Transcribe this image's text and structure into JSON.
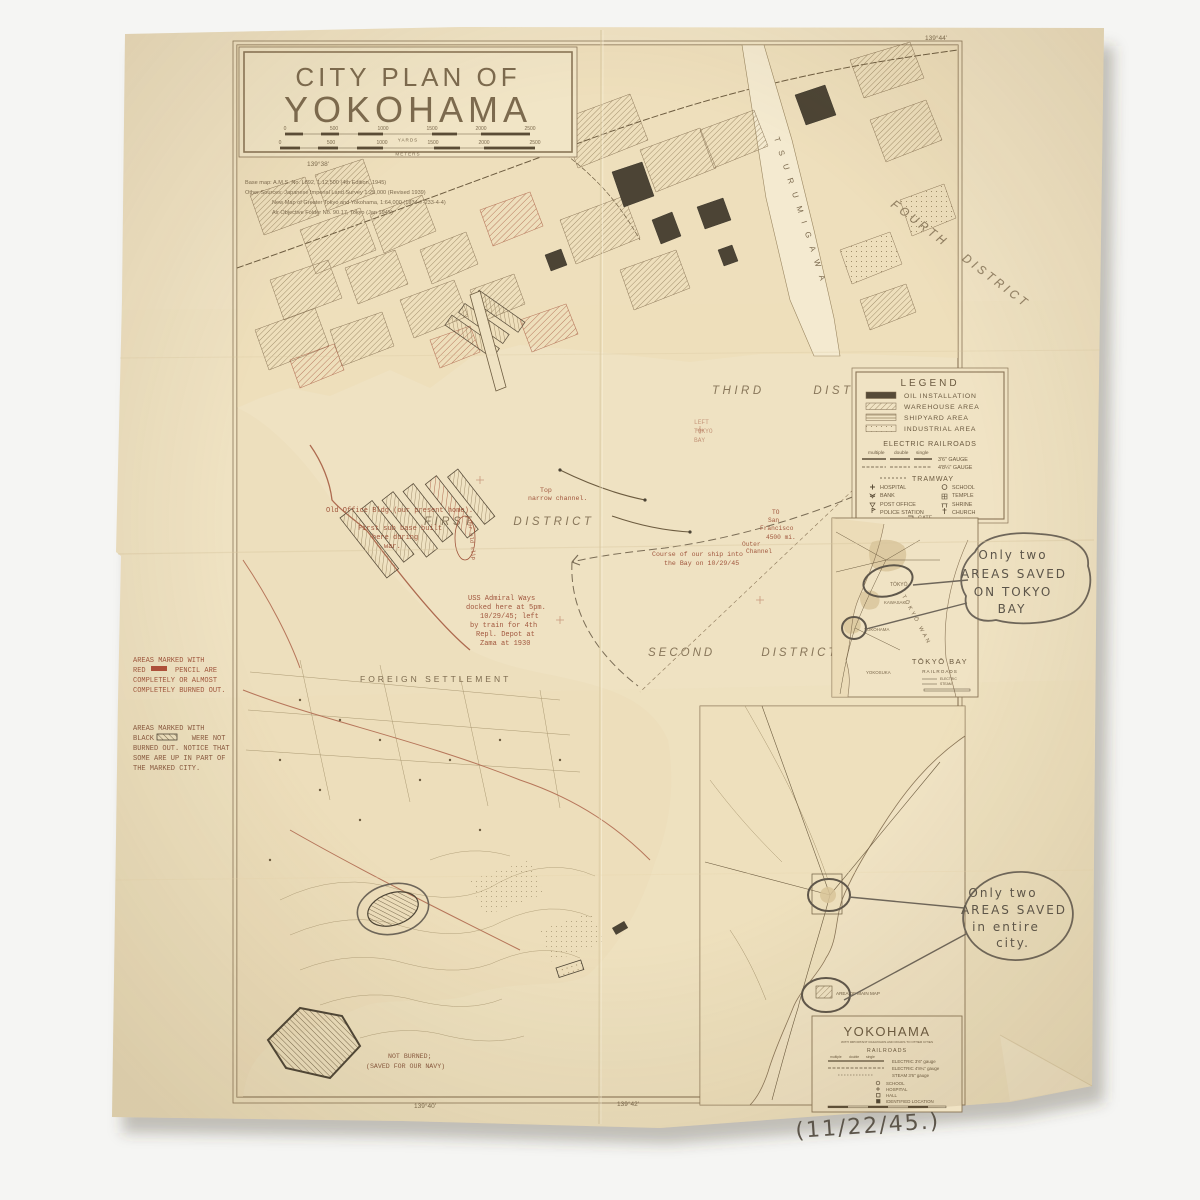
{
  "title_box": {
    "kicker": "CITY PLAN OF",
    "title": "YOKOHAMA",
    "yards_label": "YARDS",
    "meters_label": "METERS",
    "yard_ticks": [
      "0",
      "500",
      "1000",
      "1500",
      "2000",
      "2500"
    ],
    "meter_ticks": [
      "0",
      "500",
      "1000",
      "1500",
      "2000",
      "2500"
    ]
  },
  "source_notes": {
    "line1": "Base map: A.M.S. No. L892, 1:12,500 (4th Edition, 1945)",
    "line2": "Other Sources: Japanese Imperial Land Survey 1:25,000 (Revised 1939)",
    "line3": "New Map of Greater Tokyo and Yokohama, 1:64,000 (1934-7-233-4-4)",
    "line4": "Air Objective Folder No. 90.17, Tokyo (Jan 1945)"
  },
  "coords": {
    "top": "139°38'",
    "top_right": "139°44'",
    "bottom_left": "139°40'",
    "bottom_right": "139°42'"
  },
  "districts": {
    "first": "FIRST DISTRICT",
    "second": "SECOND DISTRICT",
    "third": "THIRD DISTRICT",
    "fourth": "FOURTH DISTRICT"
  },
  "map_labels": {
    "tsurumi": "TSURUMIGAWA",
    "foreign_settlement": "FOREIGN SETTLEMENT"
  },
  "legend": {
    "title": "LEGEND",
    "area_items": [
      "OIL INSTALLATION",
      "WAREHOUSE AREA",
      "SHIPYARD AREA",
      "INDUSTRIAL AREA"
    ],
    "electric_railroads": "ELECTRIC RAILROADS",
    "rail_words": [
      "multiple",
      "double",
      "single"
    ],
    "gauge1": "3'6\" GAUGE",
    "gauge2": "4'8¼\" GAUGE",
    "tramway": "TRAMWAY",
    "symbols_left": [
      "HOSPITAL",
      "BANK",
      "POST OFFICE",
      "POLICE STATION"
    ],
    "symbols_right": [
      "SCHOOL",
      "TEMPLE",
      "SHRINE",
      "CHURCH"
    ],
    "gate": "GATE"
  },
  "notes_red": [
    "AREAS MARKED WITH",
    "RED       PENCIL ARE",
    "COMPLETELY OR ALMOST",
    "COMPLETELY BURNED OUT."
  ],
  "notes_black": [
    "AREAS MARKED WITH",
    "BLACK         WERE NOT",
    "BURNED OUT. NOTICE THAT",
    "SOME ARE UP IN PART OF",
    "THE MARKED CITY."
  ],
  "typed": {
    "office": "Old Office Bldg.(our present home).",
    "subs": [
      "First sub base built",
      "here during",
      "war."
    ],
    "our_slip": "Our old slip",
    "uss": [
      "USS Admiral Ways",
      "docked here at 5pm.",
      "10/29/45; left",
      "by train for 4th",
      "Repl. Depot at",
      "Zama at 1930"
    ],
    "channel": [
      "Top",
      "narrow channel."
    ],
    "sf": [
      "TO",
      "San",
      "Francisco",
      "4500 mi."
    ],
    "outer": [
      "Outer",
      "Channel"
    ],
    "course": [
      "Course of our ship into",
      "the Bay on 10/29/45"
    ],
    "left_bay": [
      "LEFT",
      "TOKYO",
      "BAY"
    ],
    "not_burned": [
      "NOT BURNED;",
      "(SAVED FOR OUR NAVY)"
    ]
  },
  "handwritten": {
    "bubble1": [
      "Only two",
      "AREAS SAVED",
      "ON TOKYO",
      "BAY"
    ],
    "bubble2": [
      "Only two",
      "AREAS SAVED",
      "in entire",
      "city."
    ],
    "date": "(11/22/45.)"
  },
  "tokyo_bay_inset": {
    "cities": {
      "tokyo": "TŌKYŌ",
      "kawasaki": "KAWASAKI",
      "yokohama": "YOKOHAMA",
      "yokosuka": "YOKOSUKA"
    },
    "bay": "TŌKYŌ WAN",
    "title": "TŌKYŌ BAY",
    "subtitle": "RAILROADS",
    "legend_rows": [
      "ELECTRIC",
      "STEAM"
    ]
  },
  "yokohama_inset": {
    "title": "YOKOHAMA",
    "subtitle": "WITH IMPORTANT RAILROADS AND ROADS TO OTHER CITIES",
    "railroads": "RAILROADS",
    "rail_words": [
      "multiple",
      "double",
      "single"
    ],
    "rails": [
      "ELECTRIC 3'6\" gauge",
      "ELECTRIC 4'8¼\" gauge",
      "STEAM 3'6\" gauge"
    ],
    "symbols": [
      "SCHOOL",
      "HOSPITAL",
      "HALL",
      "IDENTIFIED LOCATION"
    ],
    "area_label": "AREA OF MAIN MAP"
  },
  "colors": {
    "paper": "#efe2c2",
    "ink": "#7c6a4e",
    "red_print": "#ad6a4f",
    "typed_red": "#a1573e",
    "pencil": "#5c554a",
    "dark_fill": "#4c4435"
  }
}
